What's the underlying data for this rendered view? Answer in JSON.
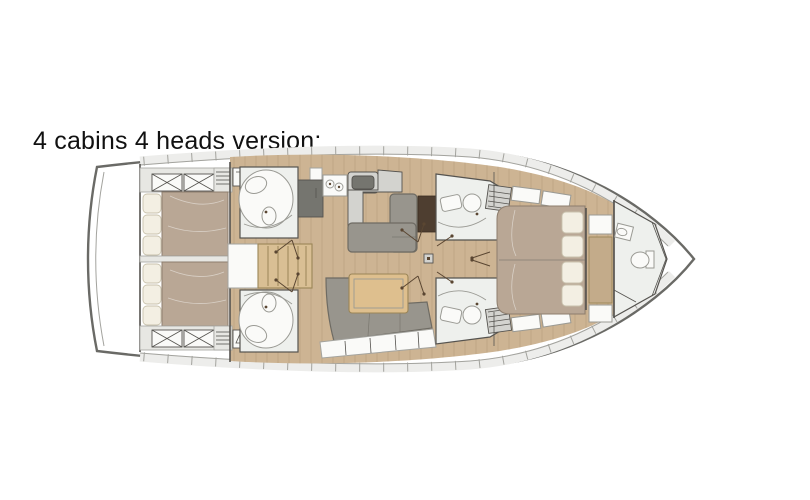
{
  "title": "4 cabins 4 heads version:",
  "plan": {
    "type": "sailboat-interior-floorplan",
    "cabins": 4,
    "heads": 4,
    "rooms": [
      "aft-cabin-starboard",
      "aft-cabin-port",
      "aft-head-starboard",
      "aft-head-port",
      "companionway-stairs",
      "galley",
      "nav-station",
      "salon",
      "forward-head-starboard",
      "forward-head-port",
      "forward-cabin",
      "bow-head"
    ]
  },
  "colors": {
    "background": "#ffffff",
    "text": "#111111",
    "hull_outline": "#6a6a66",
    "deck": "#ededeb",
    "deck_line": "#a3a39e",
    "wall": "#55534f",
    "wood_floor": "#cdb493",
    "wood_line": "#8d7452",
    "room_white": "#eef0ed",
    "storage_gray": "#e7e7e3",
    "bed_blanket": "#b9a795",
    "mattress_border": "#8d7d6d",
    "pillow": "#f3efe3",
    "pillow_border": "#c9c2ad",
    "sofa": "#98958d",
    "sofa_border": "#6e6b63",
    "table_wood": "#debf8e",
    "table_border": "#9b8557",
    "stairs_wood": "#d9bf94",
    "counter": "#d3d3cf",
    "appliance_dark": "#75756f",
    "fixture_white": "#fafaf8",
    "fixture_line": "#9a9a94",
    "desk_brown": "#4e3e30",
    "wardrobe_tan": "#c3ab8a",
    "arrow_brown": "#5a4632"
  }
}
